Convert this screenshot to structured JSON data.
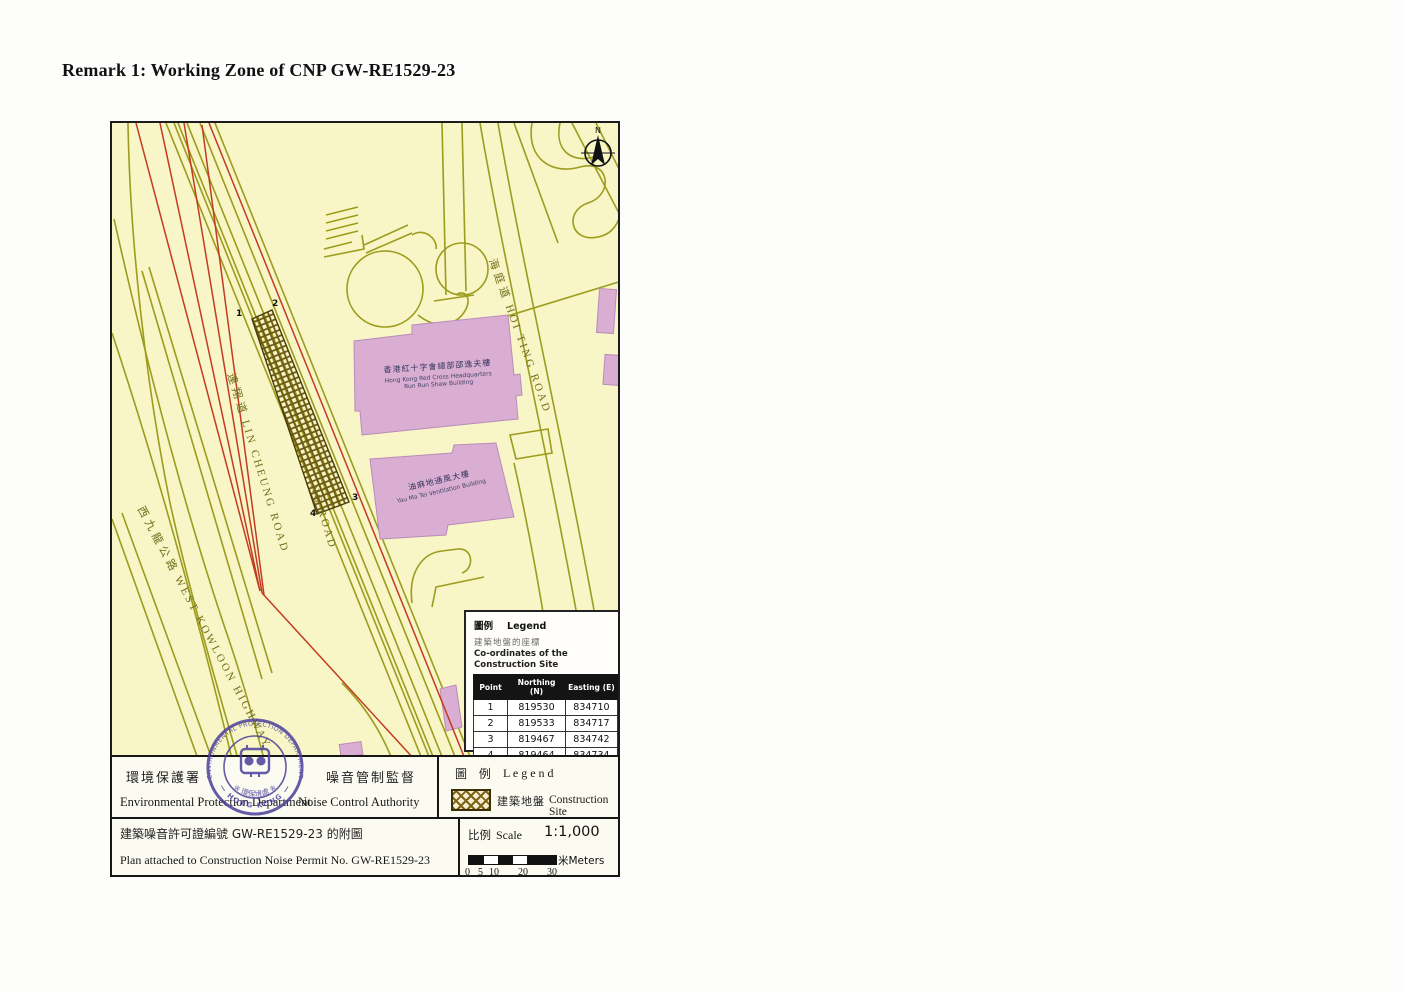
{
  "page": {
    "title": "Remark 1: Working Zone of CNP GW-RE1529-23"
  },
  "colors": {
    "map_background": "#f8f5c6",
    "road_line": "#9c9c1e",
    "red_line": "#c23b22",
    "building_fill": "#d9aed2",
    "hatch": "#7a6414",
    "stamp": "#4b3f9c"
  },
  "map": {
    "north_label": "N",
    "roads": {
      "lin_cheung": {
        "zh": "連翔道",
        "en": "LIN CHEUNG ROAD"
      },
      "lin_cheung_partial": {
        "en": "NG ROAD"
      },
      "hoi_ting": {
        "zh": "海庭道",
        "en": "HOI TING ROAD"
      },
      "west_kowloon": {
        "zh": "西九龍公路",
        "en": "WEST KOWLOON HIGHWAY"
      }
    },
    "buildings": {
      "red_cross": {
        "zh": "香港紅十字會總部邵逸夫樓",
        "en1": "Hong Kong Red Cross Headquarters",
        "en2": "Run Run Shaw Building"
      },
      "ventilation": {
        "zh": "油麻地通風大樓",
        "en1": "Yau Ma Tei Ventilation Building"
      }
    },
    "site_points": [
      "1",
      "2",
      "3",
      "4"
    ],
    "legend_box": {
      "title_zh": "圖例",
      "title_en": "Legend",
      "subtitle_zh": "建築地盤的座標",
      "subtitle_en": "Co-ordinates of the Construction Site",
      "table": {
        "headers": [
          "Point",
          "Northing (N)",
          "Easting (E)"
        ],
        "rows": [
          [
            "1",
            "819530",
            "834710"
          ],
          [
            "2",
            "819533",
            "834717"
          ],
          [
            "3",
            "819467",
            "834742"
          ],
          [
            "4",
            "819464",
            "834734"
          ]
        ]
      }
    }
  },
  "stamp": {
    "arc_top": "ENVIRONMENTAL PROTECTION DEPARTMENT",
    "arc_bottom": "— HONG KONG —",
    "band_zh": "※ 環保境處 ※"
  },
  "footer": {
    "dept_zh": "環境保護署",
    "authority_zh": "噪音管制監督",
    "dept_en": "Environmental Protection Department",
    "authority_en": "Noise Control Authority",
    "legend_zh": "圖 例",
    "legend_en": "L e g e n d",
    "site_zh": "建築地盤",
    "site_en": "Construction Site",
    "permit_zh": "建築噪音許可證編號 GW-RE1529-23 的附圖",
    "permit_en": "Plan attached to Construction Noise Permit No. GW-RE1529-23",
    "scale_zh": "比例",
    "scale_en": "Scale",
    "scale_value": "1:1,000",
    "scale_ticks": [
      "0",
      "5",
      "10",
      "20",
      "30"
    ],
    "meters_label": "米Meters"
  }
}
